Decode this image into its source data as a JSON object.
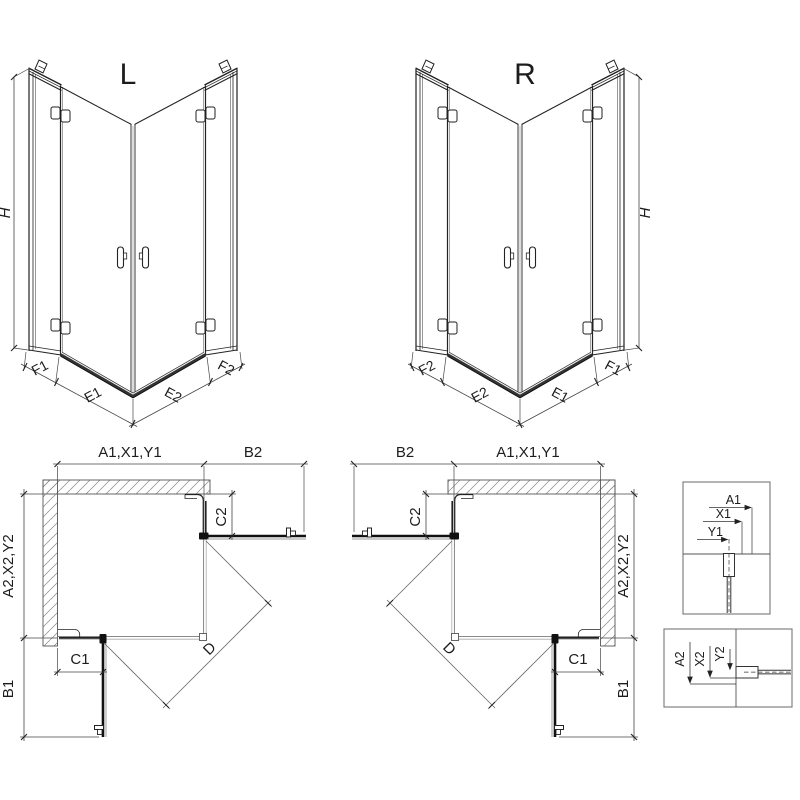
{
  "iso_left": {
    "label": "L",
    "height_label": "H",
    "f1": "F1",
    "e1": "E1",
    "e2": "E2",
    "f2": "F2"
  },
  "iso_right": {
    "label": "R",
    "height_label": "H",
    "f2": "F2",
    "e2": "E2",
    "e1": "E1",
    "f1": "F1"
  },
  "plan_left": {
    "top_width": "A1,X1,Y1",
    "top_door": "B2",
    "side_height": "A2,X2,Y2",
    "side_door": "B1",
    "fixed_right": "C2",
    "fixed_bottom": "C1",
    "diagonal": "D"
  },
  "plan_right": {
    "top_width": "A1,X1,Y1",
    "top_door": "B2",
    "side_height": "A2,X2,Y2",
    "side_door": "B1",
    "fixed_left": "C2",
    "fixed_bottom": "C1",
    "diagonal": "D"
  },
  "detail_top": {
    "a1": "A1",
    "x1": "X1",
    "y1": "Y1"
  },
  "detail_side": {
    "a2": "A2",
    "x2": "X2",
    "y2": "Y2"
  },
  "colors": {
    "line": "#222222",
    "dim": "#454545",
    "glass_gray": "#7a7a7a",
    "tray": "#333333",
    "hatch": "#888888",
    "background": "#ffffff"
  }
}
